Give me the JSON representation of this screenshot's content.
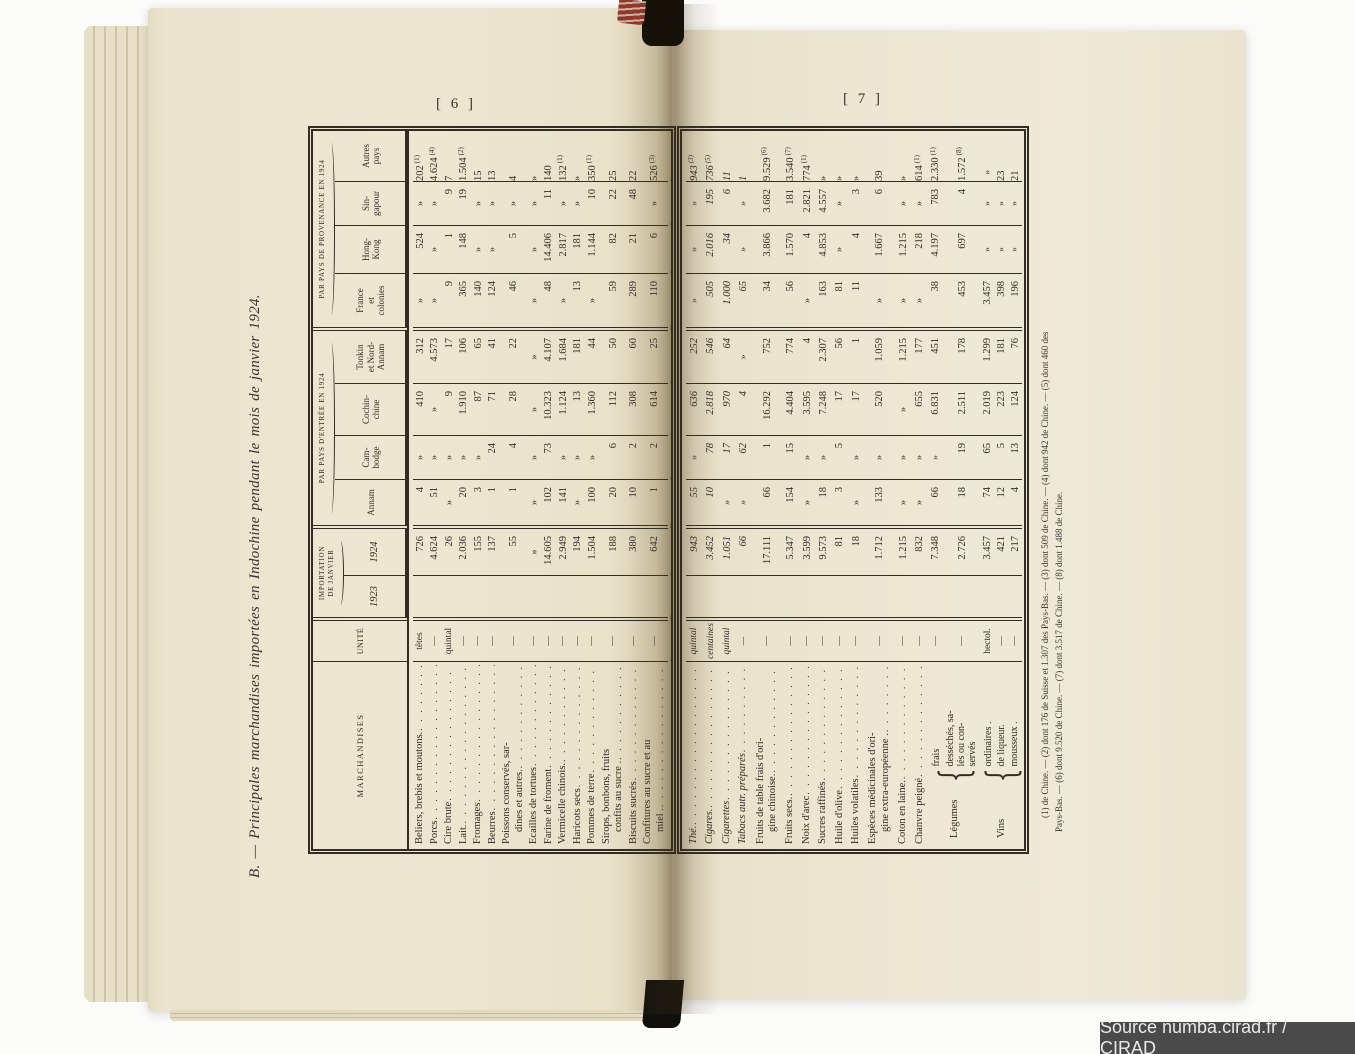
{
  "source_bar": {
    "text": "Source numba.cirad.fr / CIRAD"
  },
  "pages": {
    "left_number": "[ 6 ]",
    "right_number": "[ 7 ]",
    "title": "B. — Principales marchandises importées en Indochine pendant le mois de janvier 1924."
  },
  "table": {
    "headers": {
      "marchandises": "MARCHANDISES",
      "unite": "UNITÉ",
      "importation_line1": "IMPORTATION",
      "importation_line2": "DE JANVIER",
      "col_1923": "1923",
      "col_1924": "1924",
      "entree_group": "PAR PAYS D'ENTRÉE EN 1924",
      "provenance_group": "PAR PAYS DE PROVENANCE EN 1924",
      "entree_cols": [
        [
          "Annam"
        ],
        [
          "Cam-",
          "bodge"
        ],
        [
          "Cochin-",
          "chine"
        ],
        [
          "Tonkin",
          "et Nord-",
          "Annam"
        ]
      ],
      "provenance_cols": [
        [
          "France",
          "et",
          "colonies"
        ],
        [
          "Hong-",
          "Kong"
        ],
        [
          "Sin-",
          "gapour"
        ],
        [
          "Autres",
          "pays"
        ]
      ]
    },
    "rows_page6": [
      {
        "label": [
          "Beliers, brebis et moutons."
        ],
        "unit": "têtes",
        "y1924": "726",
        "annam": "4",
        "cambodge": "»",
        "cochinchine": "410",
        "tonkin": "312",
        "france": "»",
        "hongkong": "524",
        "singapour": "»",
        "autres": "202 (1)"
      },
      {
        "label": [
          "Porcs"
        ],
        "unit": "—",
        "y1924": "4.624",
        "annam": "51",
        "cambodge": "»",
        "cochinchine": "»",
        "tonkin": "4.573",
        "france": "»",
        "hongkong": "»",
        "singapour": "»",
        "autres": "4.624 (4)"
      },
      {
        "label": [
          "Cire brute"
        ],
        "unit": "quintal",
        "y1924": "26",
        "annam": "»",
        "cambodge": "»",
        "cochinchine": "9",
        "tonkin": "17",
        "france": "9",
        "hongkong": "1",
        "singapour": "9",
        "autres": "7"
      },
      {
        "label": [
          "Lait."
        ],
        "unit": "—",
        "y1924": "2.036",
        "annam": "20",
        "cambodge": "»",
        "cochinchine": "1.910",
        "tonkin": "106",
        "france": "365",
        "hongkong": "148",
        "singapour": "19",
        "autres": "1.504 (2)"
      },
      {
        "label": [
          "Fromages"
        ],
        "unit": "—",
        "y1924": "155",
        "annam": "3",
        "cambodge": "»",
        "cochinchine": "87",
        "tonkin": "65",
        "france": "140",
        "hongkong": "»",
        "singapour": "»",
        "autres": "15"
      },
      {
        "label": [
          "Beurres"
        ],
        "unit": "—",
        "y1924": "137",
        "annam": "1",
        "cambodge": "24",
        "cochinchine": "71",
        "tonkin": "41",
        "france": "124",
        "hongkong": "»",
        "singapour": "»",
        "autres": "13"
      },
      {
        "label": [
          "Poissons conservés, sar-",
          "dines et autres."
        ],
        "unit": "—",
        "y1924": "55",
        "annam": "1",
        "cambodge": "4",
        "cochinchine": "28",
        "tonkin": "22",
        "france": "46",
        "hongkong": "5",
        "singapour": "»",
        "autres": "4",
        "style": "two"
      },
      {
        "label": [
          "Ecailles de tortues"
        ],
        "unit": "—",
        "y1924": "»",
        "annam": "»",
        "cambodge": "»",
        "cochinchine": "»",
        "tonkin": "»",
        "france": "»",
        "hongkong": "»",
        "singapour": "»",
        "autres": "»"
      },
      {
        "label": [
          "Farine de froment"
        ],
        "unit": "—",
        "y1924": "14.605",
        "annam": "102",
        "cambodge": "73",
        "cochinchine": "10.323",
        "tonkin": "4.107",
        "france": "48",
        "hongkong": "14.406",
        "singapour": "11",
        "autres": "140"
      },
      {
        "label": [
          "Vermicelle chinois."
        ],
        "unit": "—",
        "y1924": "2.949",
        "annam": "141",
        "cambodge": "»",
        "cochinchine": "1.124",
        "tonkin": "1.684",
        "france": "»",
        "hongkong": "2.817",
        "singapour": "»",
        "autres": "132 (1)"
      },
      {
        "label": [
          "Haricots secs"
        ],
        "unit": "—",
        "y1924": "194",
        "annam": "»",
        "cambodge": "»",
        "cochinchine": "13",
        "tonkin": "181",
        "france": "13",
        "hongkong": "181",
        "singapour": "»",
        "autres": "»"
      },
      {
        "label": [
          "Pommes de terre"
        ],
        "unit": "—",
        "y1924": "1.504",
        "annam": "100",
        "cambodge": "»",
        "cochinchine": "1.360",
        "tonkin": "44",
        "france": "»",
        "hongkong": "1.144",
        "singapour": "10",
        "autres": "350 (1)"
      },
      {
        "label": [
          "Sirops, bonbons, fruits",
          "confits au sucre ."
        ],
        "unit": "—",
        "y1924": "188",
        "annam": "20",
        "cambodge": "6",
        "cochinchine": "112",
        "tonkin": "50",
        "france": "59",
        "hongkong": "82",
        "singapour": "22",
        "autres": "25",
        "style": "two"
      },
      {
        "label": [
          "Biscuits sucrés"
        ],
        "unit": "—",
        "y1924": "380",
        "annam": "10",
        "cambodge": "2",
        "cochinchine": "308",
        "tonkin": "60",
        "france": "289",
        "hongkong": "21",
        "singapour": "48",
        "autres": "22"
      },
      {
        "label": [
          "Confitures au sucre et au",
          "miel ."
        ],
        "unit": "—",
        "y1924": "642",
        "annam": "1",
        "cambodge": "2",
        "cochinchine": "614",
        "tonkin": "25",
        "france": "110",
        "hongkong": "6",
        "singapour": "»",
        "autres": "526 (3)",
        "style": "two"
      },
      {
        "label": [
          "Chocolat"
        ],
        "unit": "—",
        "y1924": "108",
        "annam": "»",
        "cambodge": "»",
        "cochinchine": "79",
        "tonkin": "29",
        "france": "95",
        "hongkong": "»",
        "singapour": "»",
        "autres": "13",
        "style": "crushed"
      }
    ],
    "rows_page7": [
      {
        "label": [
          "Thé."
        ],
        "unit": "quintal",
        "y1924": "943",
        "annam": "55",
        "cambodge": "»",
        "cochinchine": "636",
        "tonkin": "252",
        "france": "»",
        "hongkong": "»",
        "singapour": "»",
        "autres": "943 (3)",
        "style": "sitalic"
      },
      {
        "label": [
          "Cigares."
        ],
        "unit": "centaines",
        "y1924": "3.452",
        "annam": "10",
        "cambodge": "78",
        "cochinchine": "2.818",
        "tonkin": "546",
        "france": "505",
        "hongkong": "2.016",
        "singapour": "195",
        "autres": "736 (5)",
        "style": "sitalic"
      },
      {
        "label": [
          "Cigarettes"
        ],
        "unit": "quintal",
        "y1924": "1.051",
        "annam": "»",
        "cambodge": "17",
        "cochinchine": "970",
        "tonkin": "64",
        "france": "1.000",
        "hongkong": "34",
        "singapour": "6",
        "autres": "11",
        "style": "sitalic"
      },
      {
        "label": [
          "Tabacs autr. préparés"
        ],
        "unit": "—",
        "y1924": "66",
        "annam": "»",
        "cambodge": "62",
        "cochinchine": "4",
        "tonkin": "»",
        "france": "65",
        "hongkong": "»",
        "singapour": "»",
        "autres": "1",
        "style": "sitalic"
      },
      {
        "label": [
          "Fruits de table frais d'ori-",
          "gine chinoise."
        ],
        "unit": "—",
        "y1924": "17.111",
        "annam": "66",
        "cambodge": "1",
        "cochinchine": "16.292",
        "tonkin": "752",
        "france": "34",
        "hongkong": "3.866",
        "singapour": "3.682",
        "autres": "9.529 (6)",
        "style": "two"
      },
      {
        "label": [
          "Fruits secs."
        ],
        "unit": "—",
        "y1924": "5.347",
        "annam": "154",
        "cambodge": "15",
        "cochinchine": "4.404",
        "tonkin": "774",
        "france": "56",
        "hongkong": "1.570",
        "singapour": "181",
        "autres": "3.540 (7)"
      },
      {
        "label": [
          "Noix d'arec"
        ],
        "unit": "—",
        "y1924": "3.599",
        "annam": "»",
        "cambodge": "»",
        "cochinchine": "3.595",
        "tonkin": "4",
        "france": "»",
        "hongkong": "4",
        "singapour": "2.821",
        "autres": "774 (1)"
      },
      {
        "label": [
          "Sucres raffinés"
        ],
        "unit": "—",
        "y1924": "9.573",
        "annam": "18",
        "cambodge": "»",
        "cochinchine": "7.248",
        "tonkin": "2.307",
        "france": "163",
        "hongkong": "4.853",
        "singapour": "4.557",
        "autres": "»"
      },
      {
        "label": [
          "Huile d'olive"
        ],
        "unit": "—",
        "y1924": "81",
        "annam": "3",
        "cambodge": "5",
        "cochinchine": "17",
        "tonkin": "56",
        "france": "81",
        "hongkong": "»",
        "singapour": "»",
        "autres": "»"
      },
      {
        "label": [
          "Huiles volatiles"
        ],
        "unit": "—",
        "y1924": "18",
        "annam": "»",
        "cambodge": "»",
        "cochinchine": "17",
        "tonkin": "1",
        "france": "11",
        "hongkong": "4",
        "singapour": "3",
        "autres": "»"
      },
      {
        "label": [
          "Espèces médicinales d'ori-",
          "gine extra-européenne ."
        ],
        "unit": "—",
        "y1924": "1.712",
        "annam": "133",
        "cambodge": "»",
        "cochinchine": "520",
        "tonkin": "1.059",
        "france": "»",
        "hongkong": "1.667",
        "singapour": "6",
        "autres": "39",
        "style": "two"
      },
      {
        "label": [
          "Coton en laine."
        ],
        "unit": "—",
        "y1924": "1.215",
        "annam": "»",
        "cambodge": "»",
        "cochinchine": "»",
        "tonkin": "1.215",
        "france": "»",
        "hongkong": "1.215",
        "singapour": "»",
        "autres": "»"
      },
      {
        "label": [
          "Chanvre peigné"
        ],
        "unit": "—",
        "y1924": "832",
        "annam": "»",
        "cambodge": "»",
        "cochinchine": "655",
        "tonkin": "177",
        "france": "»",
        "hongkong": "218",
        "singapour": "»",
        "autres": "614 (1)"
      },
      {
        "group": "Légumes",
        "subrows": [
          {
            "label": [
              "frais"
            ],
            "fl": "fl1",
            "unit": "—",
            "y1924": "7.348",
            "annam": "66",
            "cambodge": "»",
            "cochinchine": "6.831",
            "tonkin": "451",
            "france": "38",
            "hongkong": "4.197",
            "singapour": "783",
            "autres": "2.330 (1)"
          },
          {
            "label": [
              "desséchés, sa-",
              "lés ou con-",
              "servés"
            ],
            "fl": "fl25",
            "unit": "—",
            "y1924": "2.726",
            "annam": "18",
            "cambodge": "19",
            "cochinchine": "2.511",
            "tonkin": "178",
            "france": "453",
            "hongkong": "697",
            "singapour": "4",
            "autres": "1.572 (8)"
          }
        ]
      },
      {
        "group": "Vins",
        "subrows": [
          {
            "label": [
              "ordinaires ."
            ],
            "fl": "fl1",
            "unit": "hectol.",
            "y1924": "3.457",
            "annam": "74",
            "cambodge": "65",
            "cochinchine": "2.019",
            "tonkin": "1.299",
            "france": "3.457",
            "hongkong": "»",
            "singapour": "»",
            "autres": "»"
          },
          {
            "label": [
              "de liqueur."
            ],
            "fl": "fl1",
            "unit": "—",
            "y1924": "421",
            "annam": "12",
            "cambodge": "5",
            "cochinchine": "223",
            "tonkin": "181",
            "france": "398",
            "hongkong": "»",
            "singapour": "»",
            "autres": "23"
          },
          {
            "label": [
              "mousseux ."
            ],
            "fl": "fl1",
            "unit": "—",
            "y1924": "217",
            "annam": "4",
            "cambodge": "13",
            "cochinchine": "124",
            "tonkin": "76",
            "france": "196",
            "hongkong": "»",
            "singapour": "»",
            "autres": "21"
          }
        ]
      }
    ],
    "footnote_lines": [
      "(1) de Chine. — (2) dont 176 de Suisse et 1.307 des Pays-Bas. — (3) dont 509 de Chine. — (4) dont 942 de Chine. — (5) dont 460 des",
      "Pays-Bas. — (6) dont 9.520 de Chine. — (7) dont 3.517 de Chine. — (8) dont 1.488 de Chine."
    ]
  }
}
